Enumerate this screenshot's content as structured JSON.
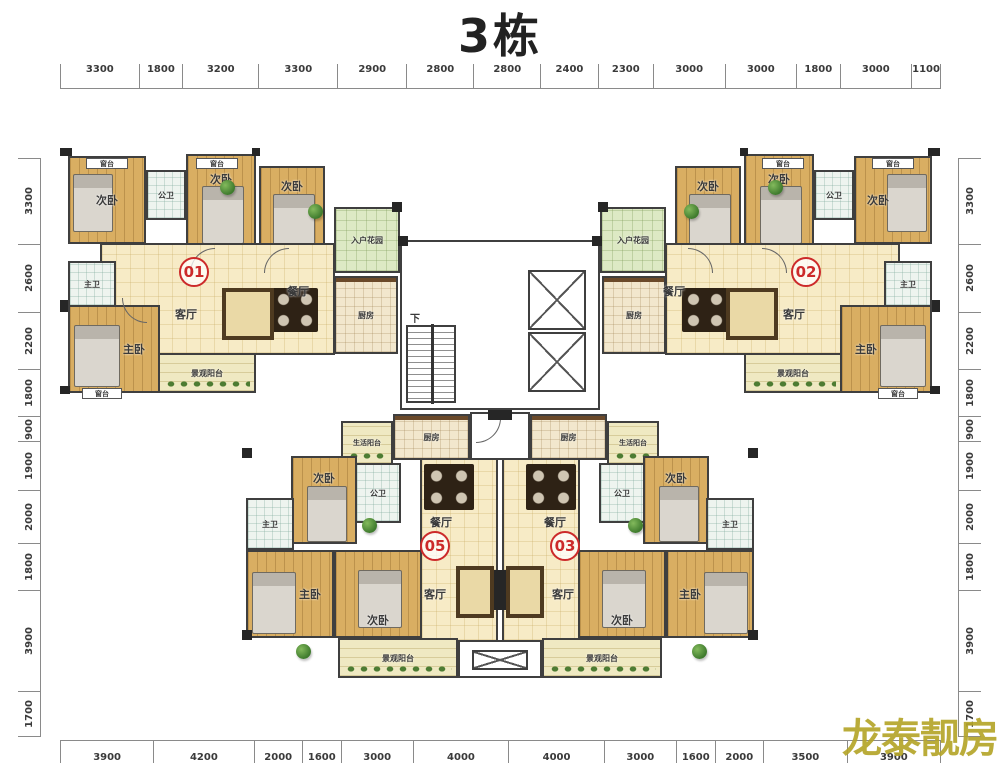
{
  "title": "3栋",
  "watermark": "龙泰靓房",
  "units": {
    "u01": "01",
    "u02": "02",
    "u05": "05",
    "u03": "03"
  },
  "room_labels": {
    "bedroom": "次卧",
    "master_bedroom": "主卧",
    "living": "客厅",
    "dining": "餐厅",
    "kitchen": "厨房",
    "public_bath": "公卫",
    "master_bath": "主卫",
    "view_balcony": "景观阳台",
    "service_balcony": "生活阳台",
    "entry_garden": "入户花园",
    "window_sill": "窗台",
    "stairs_down": "下"
  },
  "dimensions": {
    "top": [
      3300,
      1800,
      3200,
      3300,
      2900,
      2800,
      2800,
      2400,
      2300,
      3000,
      3000,
      1800,
      3000,
      1100
    ],
    "bottom": [
      3900,
      4200,
      2000,
      1600,
      3000,
      4000,
      4000,
      3000,
      1600,
      2000,
      3500,
      3900
    ],
    "left": [
      3300,
      2600,
      2200,
      1800,
      900,
      1900,
      2000,
      1800,
      3900,
      1700
    ],
    "right": [
      3300,
      2600,
      2200,
      1800,
      900,
      1900,
      2000,
      1800,
      3900,
      1700
    ]
  },
  "colors": {
    "unit_badge_red": "#cc2a2a",
    "watermark_olive": "#b5a52a",
    "wall_dark": "#2e2e2e",
    "floor_cream": "#f7ebc6",
    "floor_wood": "#d9ae62",
    "garden_green": "#dde9c4"
  }
}
